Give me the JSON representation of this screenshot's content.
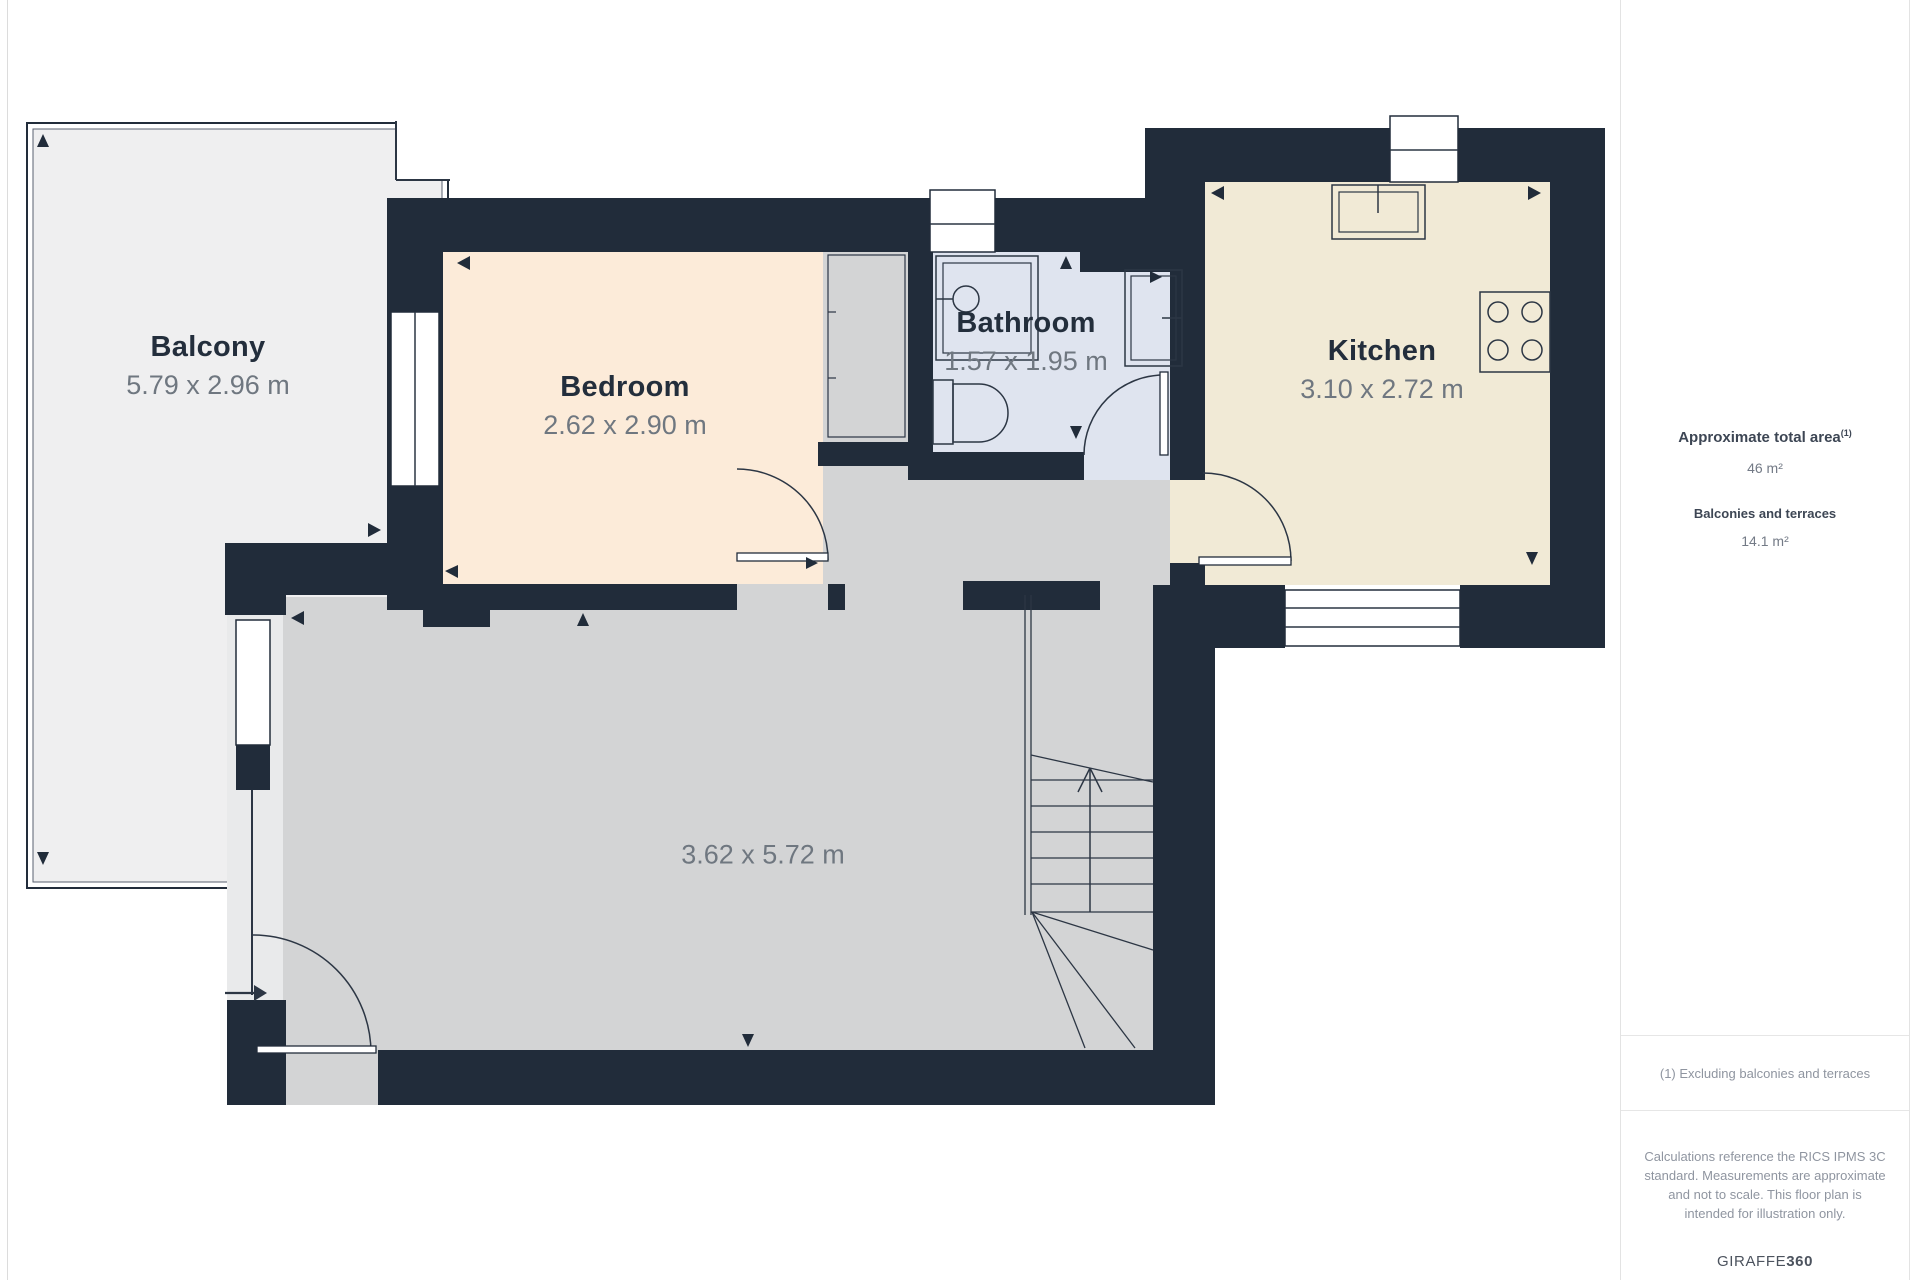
{
  "plan": {
    "rooms": [
      {
        "key": "balcony",
        "label": "Balcony",
        "dimensions": "5.79 x 2.96 m"
      },
      {
        "key": "bedroom",
        "label": "Bedroom",
        "dimensions": "2.62 x 2.90 m"
      },
      {
        "key": "bathroom",
        "label": "Bathroom",
        "dimensions": "1.57 x 1.95 m"
      },
      {
        "key": "kitchen",
        "label": "Kitchen",
        "dimensions": "3.10 x 2.72 m"
      },
      {
        "key": "living-area",
        "label": "",
        "dimensions": "3.62 x 5.72 m"
      }
    ],
    "colors": {
      "wall": "#212c3a",
      "balcony_floor": "#efeff0",
      "bedroom_floor": "#fcebd9",
      "bathroom_floor": "#dfe4ef",
      "kitchen_floor": "#f1ead6",
      "living_floor": "#d3d4d5",
      "track_floor": "#e9eaeb",
      "label_text": "#232e3c",
      "dimension_text": "#6f7780"
    }
  },
  "sidebar": {
    "total_area_label": "Approximate total area",
    "total_area_superscript": "(1)",
    "total_area_value": "46 m²",
    "balconies_label": "Balconies and terraces",
    "balconies_value": "14.1 m²",
    "footnote": "(1) Excluding balconies and terraces",
    "disclaimer": "Calculations reference the RICS IPMS 3C standard. Measurements are approximate and not to scale. This floor plan is intended for illustration only.",
    "brand_prefix": "GIRAFFE",
    "brand_suffix": "360"
  }
}
